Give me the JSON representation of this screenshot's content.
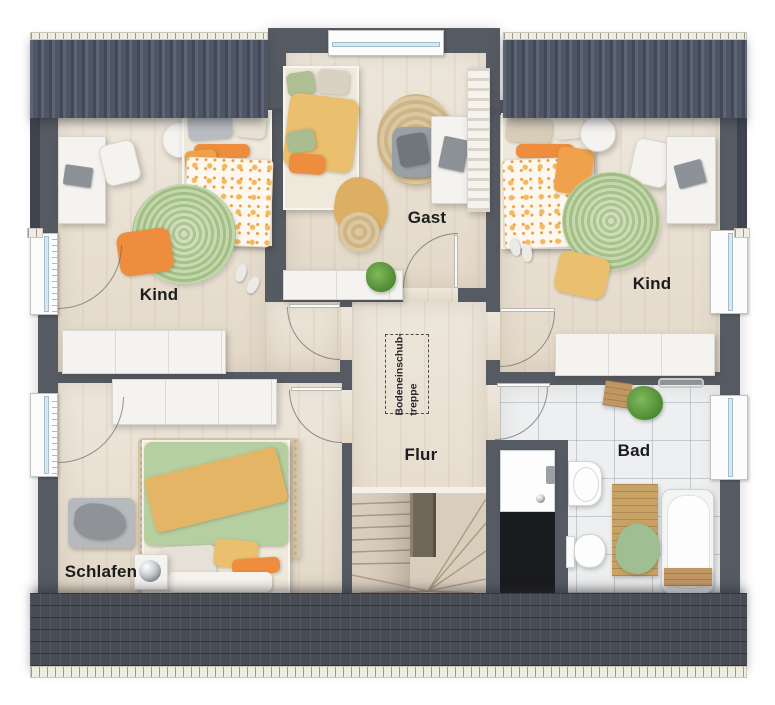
{
  "plan_title": "upper-floor-plan",
  "rooms": {
    "kind_left": {
      "label": "Kind"
    },
    "gast": {
      "label": "Gast"
    },
    "kind_right": {
      "label": "Kind"
    },
    "schlafen": {
      "label": "Schlafen"
    },
    "flur": {
      "label": "Flur"
    },
    "bad": {
      "label": "Bad"
    }
  },
  "attic_hatch": {
    "line1": "Bodeneinschub-",
    "line2": "treppe"
  },
  "colors": {
    "wall": "#565b63",
    "roof": "#4e5665",
    "roof_bottom": "#474c55",
    "gutter": "#efece2",
    "wood_floor": "#e7decf",
    "tile_floor": "#edeff0",
    "rug_green": "#b3cc97",
    "rug_jute": "#d6c199",
    "accent_orange": "#ee8d3d",
    "accent_yellow": "#eabf6d",
    "accent_green": "#b5cfa0",
    "void_dark": "#1a1b1e",
    "label_text": "#1c1c1e"
  }
}
